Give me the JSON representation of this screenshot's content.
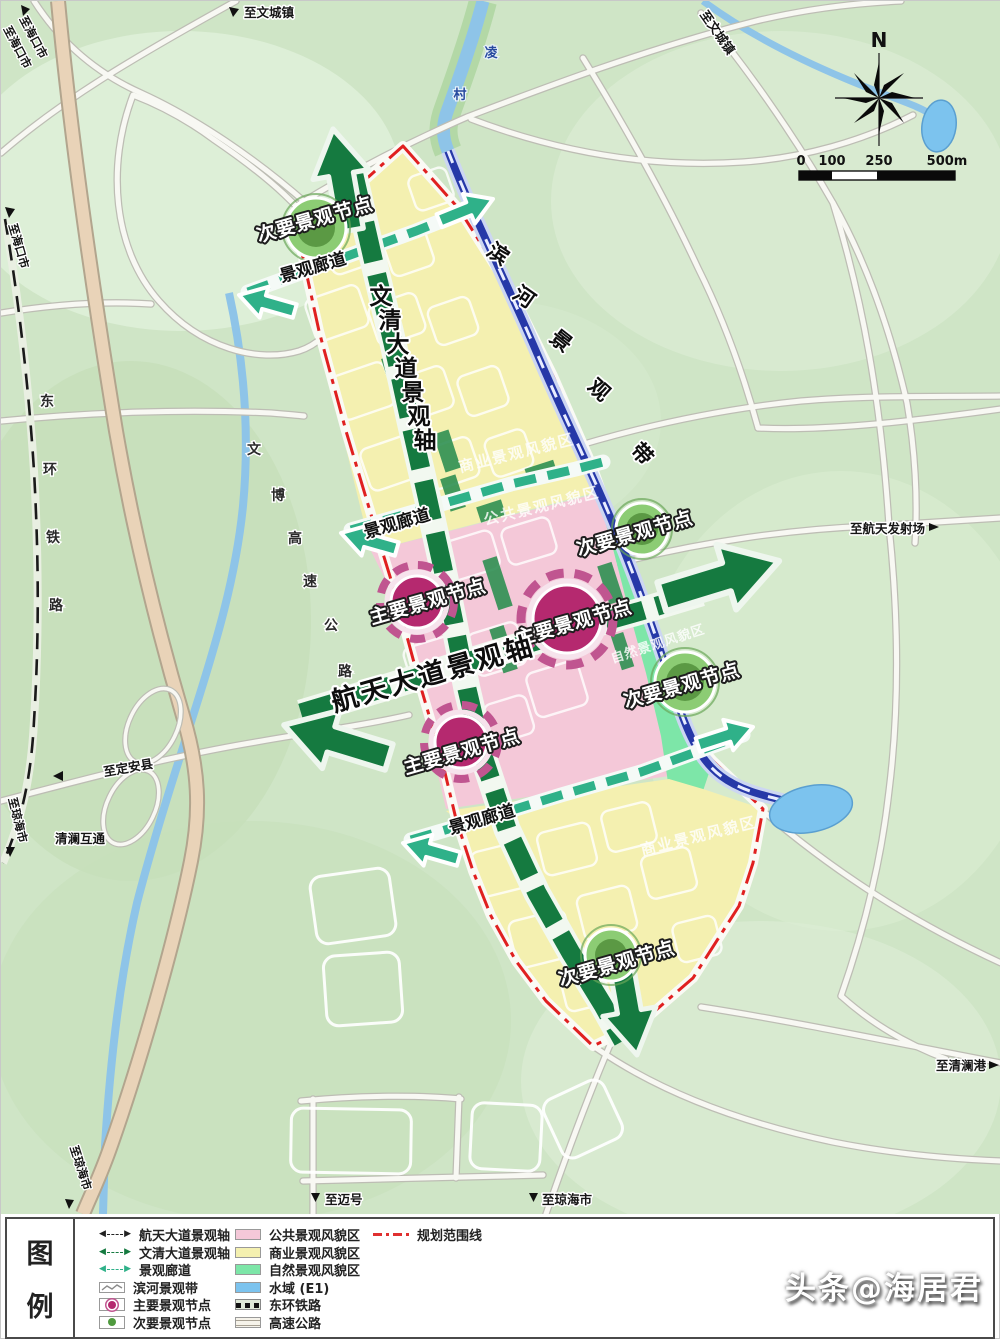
{
  "edge_labels": {
    "to_wencheng": "至文城镇",
    "to_haikou": "至海口市",
    "to_dingan": "至定安县",
    "to_qionghai": "至琼海市",
    "to_maihao": "至迈号",
    "to_launch_site": "至航天发射场",
    "to_qinglan_port": "至清澜港",
    "qinglan_interchange": "清澜互通",
    "lingcun_chars": [
      "凌",
      "村"
    ]
  },
  "lines": {
    "railway_chars": [
      "东",
      "环",
      "铁",
      "路"
    ],
    "expressway_chars": [
      "文",
      "博",
      "高",
      "速",
      "公",
      "路"
    ],
    "riverbelt_chars": [
      "滨",
      "河",
      "景",
      "观",
      "带"
    ]
  },
  "axes": {
    "hangtian": "航天大道景观轴",
    "wenqing_chars": [
      "文",
      "清",
      "大",
      "道",
      "景",
      "观",
      "轴"
    ]
  },
  "labels": {
    "corridor": "景观廊道",
    "main_node": "主要景观节点",
    "secondary_node": "次要景观节点"
  },
  "zones": {
    "public": "公共景观风貌区",
    "commercial": "商业景观风貌区",
    "natural": "自然景观风貌区"
  },
  "compass": {
    "north": "N"
  },
  "scalebar": {
    "ticks": [
      "0",
      "100",
      "250",
      "500m"
    ]
  },
  "legend": {
    "title_chars": [
      "图",
      "例"
    ],
    "col1": [
      {
        "label": "航天大道景观轴",
        "type": "arrow-black"
      },
      {
        "label": "文清大道景观轴",
        "type": "arrow-green"
      },
      {
        "label": "景观廊道",
        "type": "arrow-teal"
      },
      {
        "label": "滨河景观带",
        "type": "wave"
      },
      {
        "label": "主要景观节点",
        "type": "node-main"
      },
      {
        "label": "次要景观节点",
        "type": "node-secondary"
      }
    ],
    "col2": [
      {
        "label": "公共景观风貌区",
        "type": "fill-pink"
      },
      {
        "label": "商业景观风貌区",
        "type": "fill-yellow"
      },
      {
        "label": "自然景观风貌区",
        "type": "fill-green"
      },
      {
        "label": "水域 (E1)",
        "type": "fill-blue"
      },
      {
        "label": "东环铁路",
        "type": "railway"
      },
      {
        "label": "高速公路",
        "type": "highway"
      }
    ],
    "col3": [
      {
        "label": "规划范围线",
        "type": "boundary"
      }
    ]
  },
  "watermark": "头条@海居君",
  "colors": {
    "zone_public_pink": "#f4c8d8",
    "zone_commercial_yellow": "#f4f0b0",
    "zone_natural_green": "#7de6a8",
    "water_blue": "#7cc3ee",
    "axis_green": "#157a40",
    "corridor_teal": "#2fb189",
    "main_node_magenta": "#b5296f",
    "secondary_node_green": "#4f9a3e",
    "boundary_red": "#e02020"
  }
}
